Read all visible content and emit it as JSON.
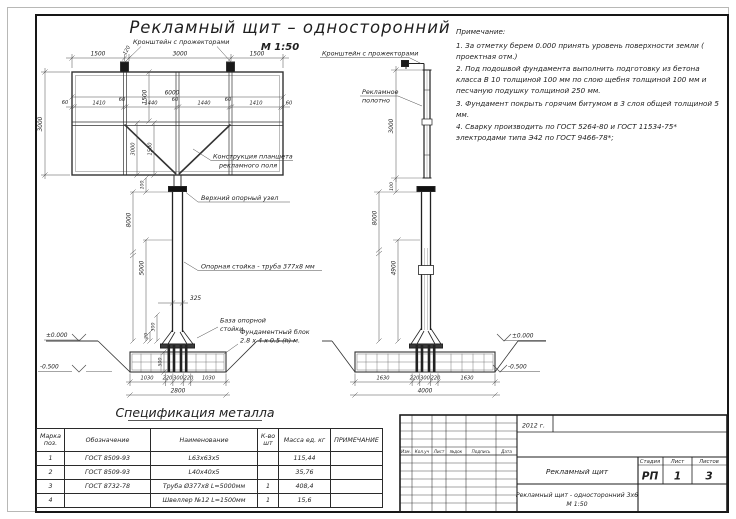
{
  "title": "Рекламный щит – односторонний",
  "scale": "М 1:50",
  "notes": {
    "heading": "Примечание:",
    "items": [
      "1. За отметку берем 0.000 принять уровень поверхности земли ( проектная отм.)",
      "2. Под подошвой фундамента выполнить подготовку из бетона класса В 10 толщиной 100 мм по слою щебня толщиной 100 мм и песчаную подушку толщиной 250 мм.",
      "3. Фундамент покрыть горячим битумом в 3 слоя общей толщиной 5 мм.",
      "4. Сварку производить по ГОСТ 5264-80 и ГОСТ 11534-75* электродами типа Э42 по ГОСТ 9466-78*;"
    ]
  },
  "front_view": {
    "labels": {
      "bracket": "Кронштейн с прожекторами",
      "panel_structure_1": "Конструкция планшета",
      "panel_structure_2": "рекламного поля",
      "top_node": "Верхний опорный узел",
      "pole": "Опорная стойка - труба 377х8 мм",
      "base_1": "База опорной",
      "base_2": "стойки",
      "foundation_1": "Фундаментный блок",
      "foundation_2": "2.8 х 4 х 0.5 (h) м.",
      "level_zero": "±0.000",
      "level_minus": "-0.500"
    },
    "dims": {
      "top": [
        "1500",
        "120",
        "3000",
        "1500"
      ],
      "width_total": "6000",
      "inner_height": "1500",
      "segments": [
        "60",
        "1410",
        "60",
        "1440",
        "60",
        "1440",
        "60",
        "1410",
        "60"
      ],
      "height": "3000",
      "brace_a": "3000",
      "brace_b": "1500",
      "gap": "100",
      "pole_total": "8000",
      "pole_lower": "5000",
      "pole_width": "325",
      "base_a": "300",
      "base_b": "20",
      "found_depth": "500",
      "found": [
        "1030",
        "220",
        "300",
        "220",
        "1030"
      ],
      "found_total": "2800"
    }
  },
  "side_view": {
    "labels": {
      "bracket": "Кронштейн с прожекторами",
      "banner_1": "Рекламное",
      "banner_2": "полотно",
      "level_zero": "±0.000",
      "level_minus": "-0.500"
    },
    "dims": {
      "height": "3000",
      "gap": "100",
      "pole_total": "8000",
      "pole_lower": "4900",
      "found": [
        "1630",
        "220",
        "300",
        "220",
        "1630"
      ],
      "found_total": "4000"
    }
  },
  "spec": {
    "heading": "Спецификация металла",
    "headers": {
      "pos": "Марка\nпоз.",
      "designation": "Обозначение",
      "name": "Наименование",
      "qty": "К-во\nшт",
      "mass": "Масса ед. кг",
      "note": "ПРИМЕЧАНИЕ"
    },
    "rows": [
      {
        "pos": "1",
        "designation": "ГОСТ  8509-93",
        "name": "L63х63х5",
        "qty": "",
        "mass": "115,44",
        "note": ""
      },
      {
        "pos": "2",
        "designation": "ГОСТ  8509-93",
        "name": "L40х40х5",
        "qty": "",
        "mass": "35,76",
        "note": ""
      },
      {
        "pos": "3",
        "designation": "ГОСТ  8732-78",
        "name": "Труба  Ø377х8  L=5000мм",
        "qty": "1",
        "mass": "408,4",
        "note": ""
      },
      {
        "pos": "4",
        "designation": "",
        "name": "Швеллер  №12  L=1500мм",
        "qty": "1",
        "mass": "15,6",
        "note": ""
      }
    ]
  },
  "title_block": {
    "year": "2012 г.",
    "doc_name": "Рекламный щит",
    "subtitle_1": "Рекламный щит - односторонний 3х6",
    "subtitle_2": "М 1:50",
    "stage_label": "Стадия",
    "sheet_label": "Лист",
    "sheets_label": "Листов",
    "stage": "РП",
    "sheet": "1",
    "sheets": "3",
    "cols": [
      "Изм.",
      "Кол.уч",
      "Лист",
      "№док",
      "Подпись",
      "Дата"
    ]
  }
}
